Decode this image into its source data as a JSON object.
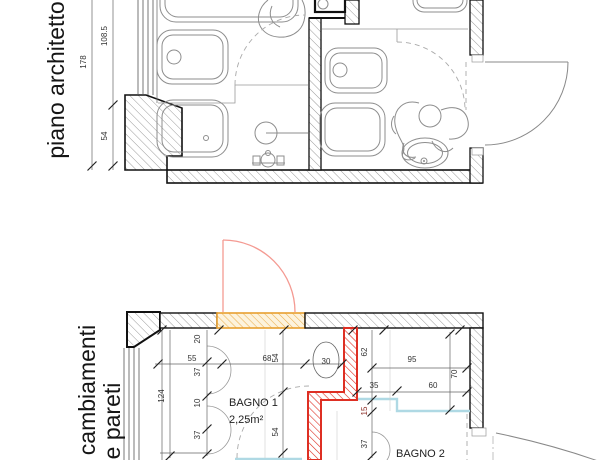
{
  "colors": {
    "wall_hatch": "#9a9a9a",
    "new_wall_red": "#de2f23",
    "new_door_pink": "#f49a92",
    "opening_orange": "#e8a030",
    "demolition_cyan": "#afd9e4",
    "dim_text": "#333333",
    "dim_text_red": "#8c2f28"
  },
  "plans": {
    "top": {
      "title": "piano architetto",
      "dims": {
        "total": "178",
        "upper": "108.5",
        "lower": "54"
      }
    },
    "bottom": {
      "title1": "cambiamenti",
      "title2": "e pareti",
      "rooms": {
        "bagno1": "BAGNO 1",
        "bagno1_area": "2,25m²",
        "bagno2": "BAGNO 2"
      },
      "dims": {
        "left_total": "124",
        "col2": [
          "20",
          "37",
          "10",
          "37"
        ],
        "top_row": [
          "55",
          "68"
        ],
        "mid54": [
          "54",
          "54"
        ],
        "basin": "30",
        "right": {
          "v62": "62",
          "w95": "95",
          "w35": "35",
          "w60": "60",
          "v70": "70",
          "v15": "15",
          "v37": "37"
        }
      }
    }
  }
}
